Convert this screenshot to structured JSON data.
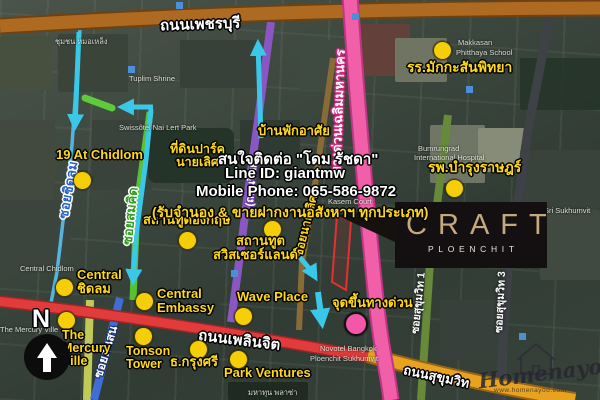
{
  "app": {
    "type": "annotated satellite location map",
    "subject": "CRAFT Ploenchit condominium neighbourhood map, Bangkok"
  },
  "colors": {
    "label_yellow": "#ffd912",
    "dot_yellow": "#f6ce08",
    "dot_pink": "#f457a8",
    "road_phetchaburi_brown": "#ad6a20",
    "road_expressway_pink": "#f05fa8",
    "road_witthayu_purple": "#8a56c2",
    "road_ploenchit_red": "#e23b3b",
    "road_sukhumvit_orange": "#e7a21f",
    "route_cyan": "#3ac8e8",
    "route_green": "#5fca3c",
    "logo_bg": "#141012",
    "logo_gold": "#c6a87b"
  },
  "contact": {
    "line1": "สนใจติดต่อ \"โดม รัชดา\"",
    "line2": "Line ID: giantmw",
    "line3": "Mobile Phone: 065-586-9872",
    "line4": "(รับจำนอง & ขายฝากงานอสังหาฯ ทุกประเภท)"
  },
  "logo": {
    "brand": "CRAFT",
    "sub": "PLOENCHIT"
  },
  "compass": {
    "north": "N"
  },
  "watermark": {
    "script": "Homenayoo",
    "url": "www.homenayoo.com"
  },
  "roads": {
    "phetchaburi": "ถนนเพชรบุรี",
    "expressway": "ทางด่วนเฉลิมมหานคร",
    "witthayu": "(ถนนวิทยุ)",
    "ploenchit": "ถนนเพลินจิต",
    "sukhumvit": "ถนนสุขุมวิท",
    "soi_chidlom": "ซอยชิดลม",
    "soi_somkid": "ซอยสมคิด",
    "soi_nai_lert": "ซอยนายเลิศ",
    "soi_tonson": "ซอยต้นสน",
    "soi_sukhumvit1": "ซอยสุขุมวิท 1",
    "soi_sukhumvit3": "ซอยสุขุมวิท 3"
  },
  "pois": {
    "chidlom19": {
      "lines": [
        "19 At Chidlom"
      ]
    },
    "nai_lert_park": {
      "lines": [
        "ที่ดินปาร์ค",
        "นายเลิศ"
      ]
    },
    "residence": {
      "lines": [
        "บ้านพักอาศัย"
      ]
    },
    "makkasan_school": {
      "lines": [
        "รร.มักกะสันพิทยา"
      ]
    },
    "bumrungrad": {
      "lines": [
        "รพ.บำรุงราษฎร์"
      ]
    },
    "british_embassy": {
      "lines": [
        "สถานทูตอังกฤษ"
      ]
    },
    "swiss_embassy": {
      "lines": [
        "สถานทูต",
        "สวิสเซอร์แลนด์"
      ]
    },
    "central_chidlom": {
      "lines": [
        "Central",
        "ชิดลม"
      ]
    },
    "central_embassy": {
      "lines": [
        "Central",
        "Embassy"
      ]
    },
    "wave_place": {
      "lines": [
        "Wave Place"
      ]
    },
    "expressway_entry": {
      "lines": [
        "จุดขึ้นทางด่วน"
      ]
    },
    "mercury_ville": {
      "lines": [
        "The",
        "Mercury",
        "Ville"
      ]
    },
    "tonson_tower": {
      "lines": [
        "Tonson",
        "Tower"
      ]
    },
    "krungsri_bank": {
      "lines": [
        "ธ.กรุงศรี"
      ]
    },
    "park_ventures": {
      "lines": [
        "Park Ventures"
      ]
    }
  },
  "base_labels": {
    "community": "ชุมชน หมอเหล็ง",
    "tuplim": "Tuplim Shrine",
    "swissotel": "Swissôtel Nai Lert Park",
    "makkasan1": "Makkasan",
    "makkasan2": "Phitthaya School",
    "bumrungrad1": "Bumrungrad",
    "bumrungrad2": "International Hospital",
    "kasem": "Kasem Court",
    "central": "Central Chidlom",
    "mercury": "The Mercury Ville",
    "hotel": "Novotel Bangkok",
    "hotel2": "Ploenchit Sukhumvit",
    "sri": "Sri Sukhumvit",
    "mahatun": "มหาทุน พลาซ่า"
  }
}
